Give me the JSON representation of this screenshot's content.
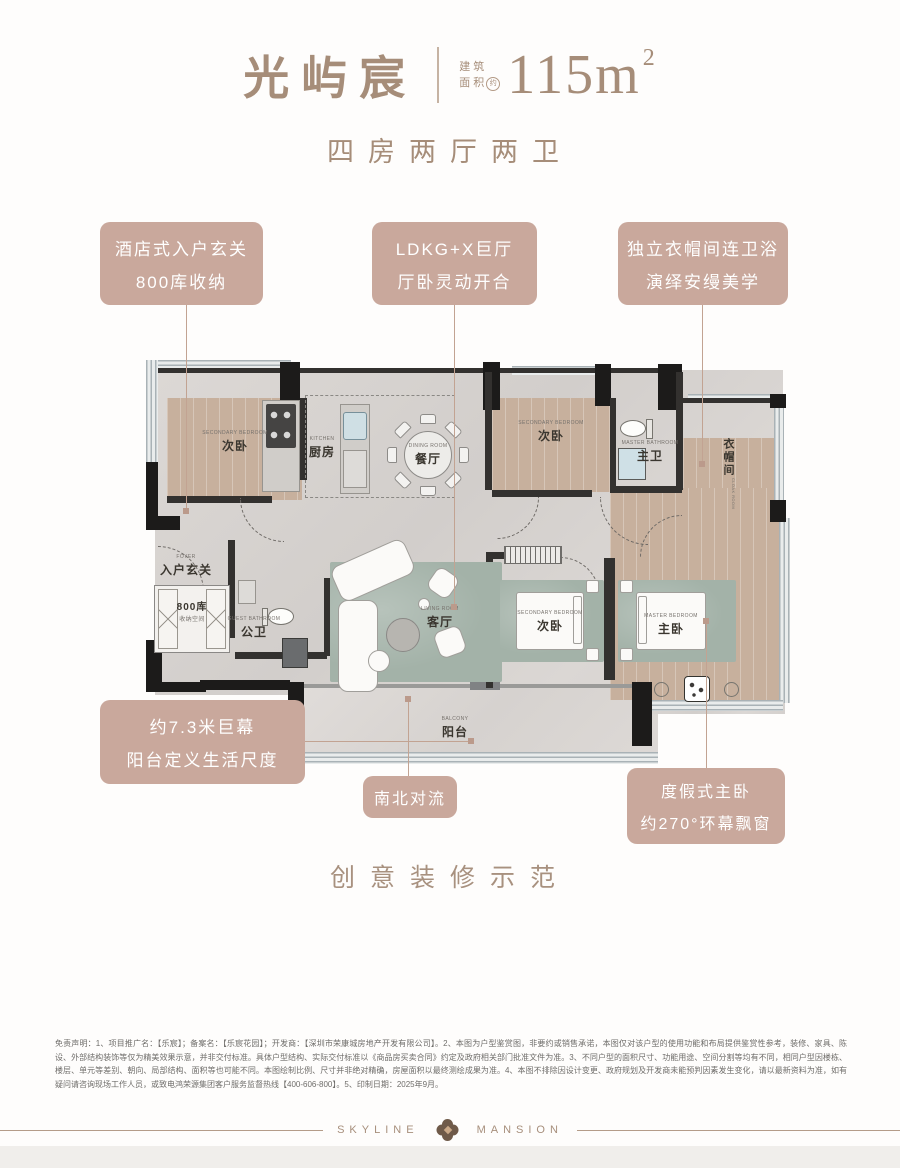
{
  "title": {
    "name": "光屿宸",
    "area_label1": "建筑",
    "area_label2": "面积",
    "area_approx": "约",
    "area_value": "115m",
    "area_unit_sup": "2",
    "subtitle": "四房两厅两卫"
  },
  "callouts": {
    "top": [
      {
        "lines": [
          "酒店式入户玄关",
          "800库收纳"
        ]
      },
      {
        "lines": [
          "LDKG+X巨厅",
          "厅卧灵动开合"
        ]
      },
      {
        "lines": [
          "独立衣帽间连卫浴",
          "演绎安缦美学"
        ]
      }
    ],
    "bottom": [
      {
        "lines": [
          "约7.3米巨幕",
          "阳台定义生活尺度"
        ]
      },
      {
        "lines": [
          "南北对流"
        ]
      },
      {
        "lines": [
          "度假式主卧",
          "约270°环幕飘窗"
        ]
      }
    ]
  },
  "rooms": [
    {
      "en": "SECONDARY BEDROOM",
      "zh": "次卧"
    },
    {
      "en": "KITCHEN",
      "zh": "厨房"
    },
    {
      "en": "DINING ROOM",
      "zh": "餐厅"
    },
    {
      "en": "SECONDARY BEDROOM",
      "zh": "次卧"
    },
    {
      "en": "MASTER BATHROOM",
      "zh": "主卫"
    },
    {
      "en": "CLOAK ROOM",
      "zh": "衣帽间"
    },
    {
      "en": "FOYER",
      "zh": "入户玄关"
    },
    {
      "en": "GUEST BATHROOM",
      "zh": "公卫"
    },
    {
      "en": "LIVING ROOM",
      "zh": "客厅"
    },
    {
      "en": "SECONDARY BEDROOM",
      "zh": "次卧"
    },
    {
      "en": "MASTER BEDROOM",
      "zh": "主卧"
    },
    {
      "en": "BALCONY",
      "zh": "阳台"
    }
  ],
  "storage": {
    "line1": "800库",
    "line2": "收纳空间"
  },
  "tagline": "创意装修示范",
  "disclaimer": "免责声明：1、项目推广名：【乐宸】；备案名：【乐宸花园】；开发商：【深圳市荣康城房地产开发有限公司】。2、本图为户型鉴赏图，非要约或销售承诺，本图仅对该户型的使用功能和布局提供鉴赏性参考，装修、家具、陈设、外部结构装饰等仅为精美效果示意，并非交付标准。具体户型结构、实际交付标准以《商品房买卖合同》约定及政府相关部门批准文件为准。3、不同户型的面积尺寸、功能用途、空间分割等均有不同，相同户型因楼栋、楼层、单元等差别、朝向、局部结构、面积等也可能不同。本图绘制比例、尺寸并非绝对精确，房屋面积以最终测绘成果为准。4、本图不排除因设计变更、政府规划及开发商未能预判因素发生变化，请以最新资料为准，如有疑问请咨询现场工作人员，或致电鸿荣源集团客户服务监督热线【400-606-800】。5、印制日期：2025年9月。",
  "footer": {
    "brand_left": "SKYLINE",
    "brand_right": "MANSION"
  },
  "colors": {
    "accent": "#c9a89c",
    "title": "#a68d79",
    "connector": "#c2a392"
  }
}
